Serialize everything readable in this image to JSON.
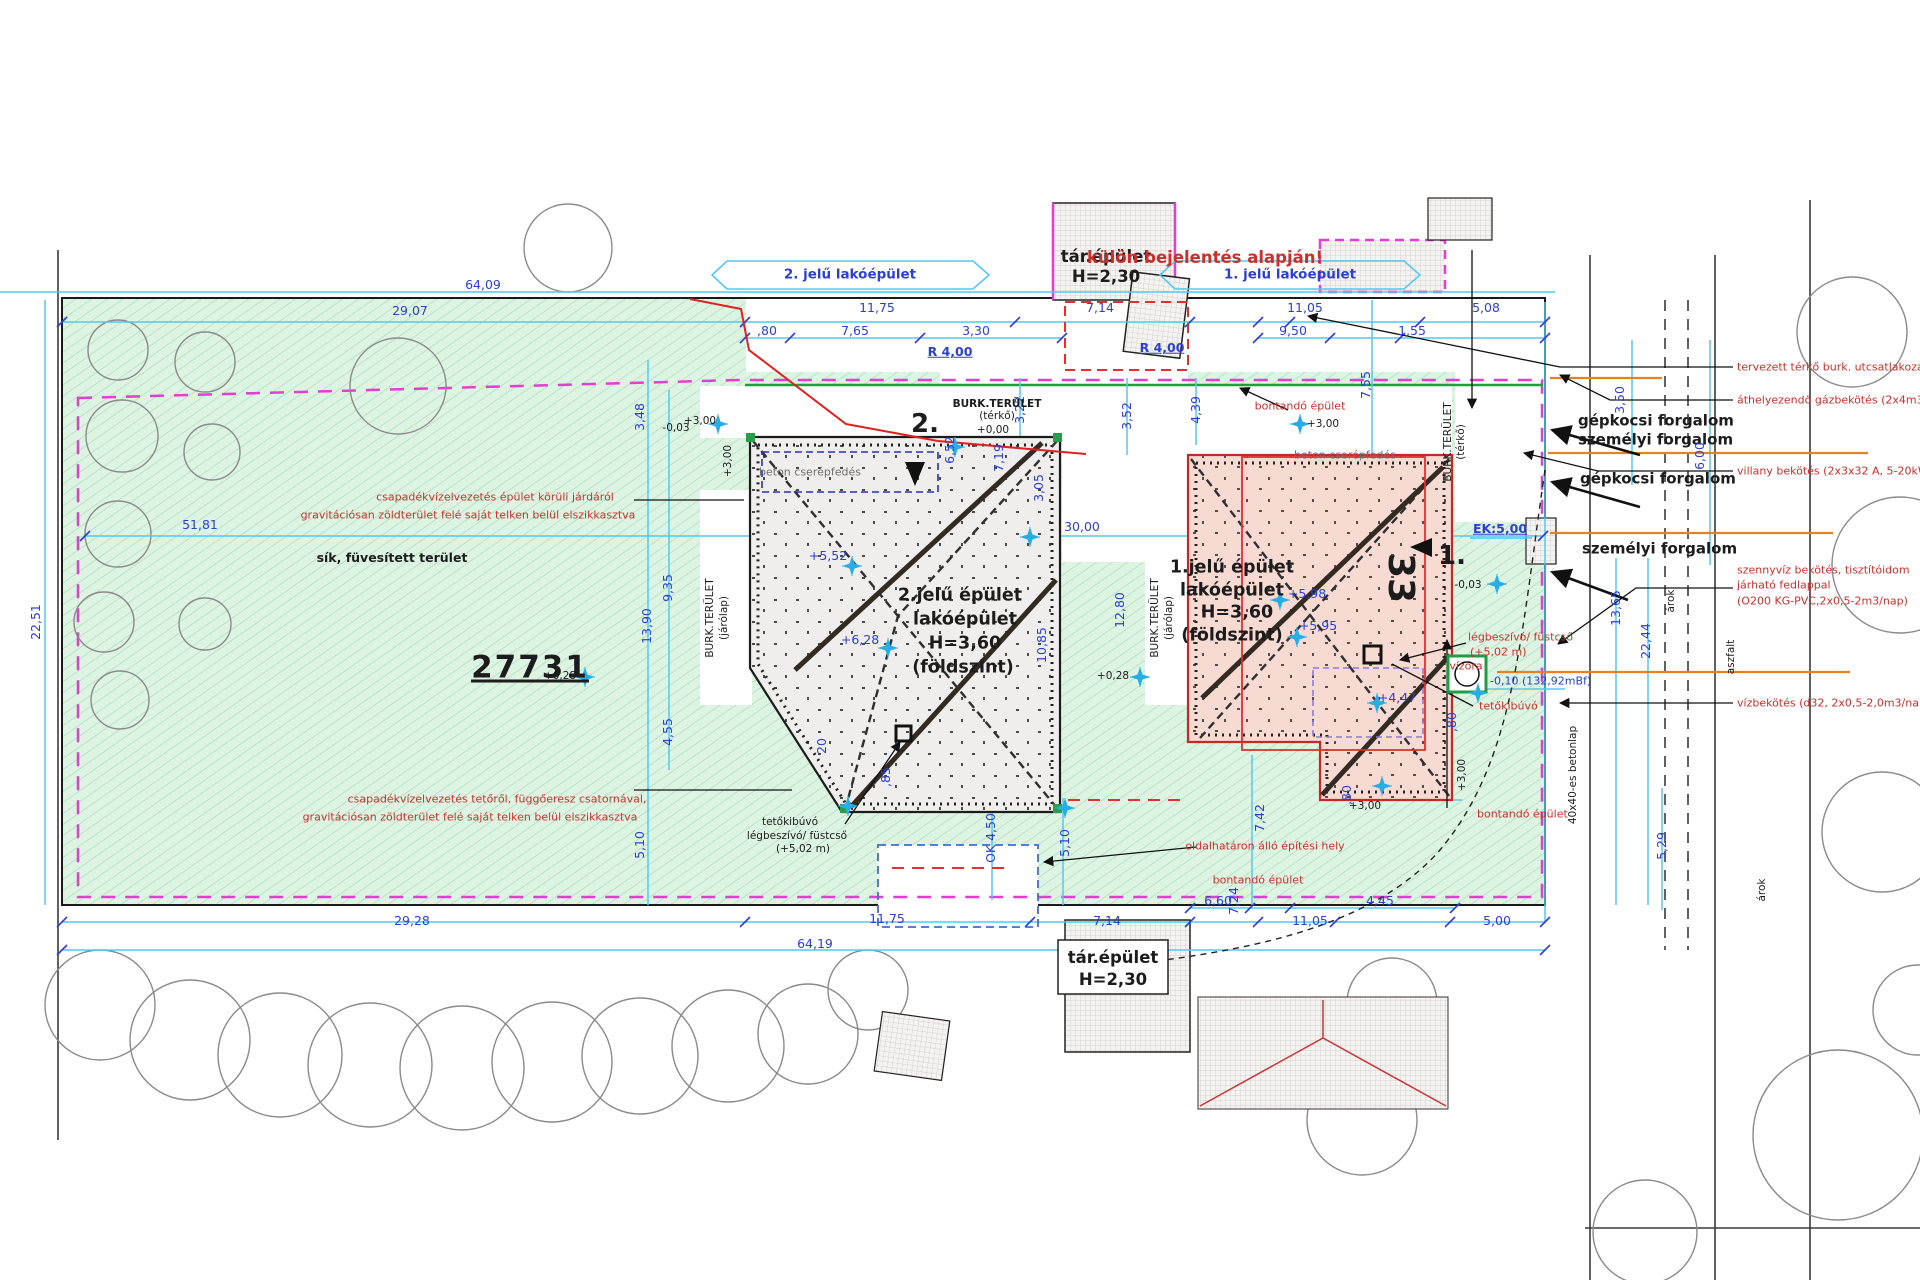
{
  "meta": {
    "title": "Helyszínrajz - telek beépítési terv",
    "parcel_number": "27731",
    "note": "külön bejelentés alapján!"
  },
  "colors": {
    "dimension_blue": "#2b3fd0",
    "dimension_line_cyan": "#56c7ee",
    "annotation_red": "#c9302c",
    "lot_green": "#def4e3",
    "boundary_magenta": "#e23ed0",
    "boundary_green": "#1f9e40",
    "utility_orange": "#e8821e",
    "building1_fill": "#f7dbd3",
    "building2_fill": "#efeeec"
  },
  "buildings": {
    "left": {
      "name": "2.jelű épület",
      "type": "lakóépület",
      "height": "H=3,60",
      "level": "(földszint)",
      "roof": "beton cserépfedés"
    },
    "right": {
      "name": "1.jelű épület",
      "type": "lakóépület",
      "height": "H=3,60",
      "level": "(földszint)",
      "roof": "beton cserépfedés",
      "house_number": "33"
    },
    "aux": {
      "name": "tár.épület",
      "height": "H=2,30"
    }
  },
  "labels": [
    {
      "n": "label-lakoepulet-2",
      "t": "2. jelű lakóépület",
      "x": 850,
      "y": 275,
      "c": "c-dim s13 b"
    },
    {
      "n": "label-tarepulet-top",
      "t": "tár.épület",
      "x": 1106,
      "y": 257,
      "c": "c-blk s16 b"
    },
    {
      "n": "label-tarepulet-top-h",
      "t": "H=2,30",
      "x": 1106,
      "y": 277,
      "c": "c-blk s16 b"
    },
    {
      "n": "label-kulon-bejelentes",
      "t": "külön bejelentés alapján!",
      "x": 1205,
      "y": 258,
      "c": "c-red s16 b"
    },
    {
      "n": "label-lakoepulet-1",
      "t": "1. jelű lakóépület",
      "x": 1290,
      "y": 275,
      "c": "c-dim s13 b"
    },
    {
      "t": "64,09",
      "x": 483,
      "y": 285,
      "c": "c-dim s12"
    },
    {
      "t": "29,07",
      "x": 410,
      "y": 311,
      "c": "c-dim s12"
    },
    {
      "t": "11,75",
      "x": 877,
      "y": 308,
      "c": "c-dim s12"
    },
    {
      "t": "7,14",
      "x": 1100,
      "y": 308,
      "c": "c-dim s12"
    },
    {
      "t": "11,05",
      "x": 1305,
      "y": 308,
      "c": "c-dim s12"
    },
    {
      "t": "5,08",
      "x": 1486,
      "y": 308,
      "c": "c-dim s12"
    },
    {
      "t": ",80",
      "x": 767,
      "y": 331,
      "c": "c-dim s12"
    },
    {
      "t": "7,65",
      "x": 855,
      "y": 331,
      "c": "c-dim s12"
    },
    {
      "t": "3,30",
      "x": 976,
      "y": 331,
      "c": "c-dim s12"
    },
    {
      "t": "9,50",
      "x": 1293,
      "y": 331,
      "c": "c-dim s12"
    },
    {
      "t": "1,55",
      "x": 1412,
      "y": 331,
      "c": "c-dim s12"
    },
    {
      "t": "R 4,00",
      "x": 950,
      "y": 352,
      "c": "c-dim s12 b u"
    },
    {
      "t": "R 4,00",
      "x": 1162,
      "y": 348,
      "c": "c-dim s12 b u"
    },
    {
      "t": "7,55",
      "x": 1366,
      "y": 385,
      "c": "c-dim s12 rot"
    },
    {
      "t": "3,22",
      "x": 1020,
      "y": 410,
      "c": "c-dim s12 rot"
    },
    {
      "t": "3,52",
      "x": 1127,
      "y": 416,
      "c": "c-dim s12 rot"
    },
    {
      "t": "4,39",
      "x": 1196,
      "y": 410,
      "c": "c-dim s12 rot"
    },
    {
      "n": "label-burkterulet-terko",
      "t": "BURK.TERÜLET",
      "x": 997,
      "y": 404,
      "c": "c-blk s10 b"
    },
    {
      "t": "(térkő)",
      "x": 997,
      "y": 416,
      "c": "c-blk s10"
    },
    {
      "t": "+0,00",
      "x": 993,
      "y": 430,
      "c": "c-blk s10"
    },
    {
      "t": "+3,00",
      "x": 700,
      "y": 421,
      "c": "c-blk s10"
    },
    {
      "t": "-0,03",
      "x": 676,
      "y": 428,
      "c": "c-blk s10"
    },
    {
      "t": "3,48",
      "x": 640,
      "y": 417,
      "c": "c-dim s12 rot"
    },
    {
      "t": "+3,00",
      "x": 728,
      "y": 461,
      "c": "c-blk s10 rot"
    },
    {
      "t": "+3,00",
      "x": 1323,
      "y": 424,
      "c": "c-blk s10"
    },
    {
      "t": "6,52",
      "x": 950,
      "y": 450,
      "c": "c-dim s12 rot"
    },
    {
      "t": "7,19",
      "x": 999,
      "y": 458,
      "c": "c-dim s12 rot"
    },
    {
      "t": "3,05",
      "x": 1039,
      "y": 488,
      "c": "c-dim s12 rot"
    },
    {
      "n": "label-bontando-top",
      "t": "bontandó épület",
      "x": 1300,
      "y": 406,
      "c": "c-red s11"
    },
    {
      "n": "label-tervezett-terko",
      "t": "tervezett térkő burk. utcsatlakozás",
      "x": 1737,
      "y": 367,
      "c": "c-red s11 la"
    },
    {
      "n": "label-gazbekotes",
      "t": "áthelyezendő gázbekötés (2x4m3/h)",
      "x": 1737,
      "y": 400,
      "c": "c-red s11 la"
    },
    {
      "n": "label-gepkocsi-1",
      "t": "gépkocsi forgalom",
      "x": 1578,
      "y": 421,
      "c": "c-blk s15 b la"
    },
    {
      "n": "label-szemelyi-1",
      "t": "személyi forgalom",
      "x": 1578,
      "y": 440,
      "c": "c-blk s15 b la"
    },
    {
      "t": "3,50",
      "x": 1620,
      "y": 400,
      "c": "c-dim s12 rot"
    },
    {
      "n": "label-villany",
      "t": "villany bekötés (2x3x32 A, 5-20kWh)",
      "x": 1737,
      "y": 471,
      "c": "c-red s11 la"
    },
    {
      "n": "label-gepkocsi-2",
      "t": "gépkocsi forgalom",
      "x": 1580,
      "y": 479,
      "c": "c-blk s15 b la"
    },
    {
      "t": "6,00",
      "x": 1700,
      "y": 456,
      "c": "c-dim s12 rot"
    },
    {
      "n": "label-szemelyi-2",
      "t": "személyi forgalom",
      "x": 1582,
      "y": 549,
      "c": "c-blk s15 b la"
    },
    {
      "n": "label-szennyviz-1",
      "t": "szennyvíz bekötés, tisztítóidom",
      "x": 1737,
      "y": 570,
      "c": "c-red s11 la"
    },
    {
      "t": "járható fedlappal",
      "x": 1737,
      "y": 585,
      "c": "c-red s11 la"
    },
    {
      "t": "(O200 KG-PVC,2x0,5-2m3/nap)",
      "x": 1737,
      "y": 601,
      "c": "c-red s11 la"
    },
    {
      "n": "label-vizbekotes",
      "t": "vízbekötés (d32, 2x0,5-2,0m3/nap)",
      "x": 1737,
      "y": 703,
      "c": "c-red s11 la"
    },
    {
      "t": "árok",
      "x": 1671,
      "y": 601,
      "c": "c-blk s10 rot"
    },
    {
      "t": "aszfalt",
      "x": 1731,
      "y": 657,
      "c": "c-blk s10 rot"
    },
    {
      "t": "13,65",
      "x": 1616,
      "y": 608,
      "c": "c-dim s12 rot"
    },
    {
      "t": "22,44",
      "x": 1646,
      "y": 641,
      "c": "c-dim s12 rot"
    },
    {
      "t": "5,29",
      "x": 1662,
      "y": 846,
      "c": "c-dim s12 rot"
    },
    {
      "t": "árok",
      "x": 1762,
      "y": 890,
      "c": "c-blk s10 rot"
    },
    {
      "t": "40x40-es betonlap",
      "x": 1573,
      "y": 775,
      "c": "c-blk s10 rot"
    },
    {
      "t": "51,81",
      "x": 200,
      "y": 525,
      "c": "c-dim s12"
    },
    {
      "t": "22,51",
      "x": 36,
      "y": 622,
      "c": "c-dim s12 rot"
    },
    {
      "n": "label-fuvesitett",
      "t": "sík, füvesített terület",
      "x": 392,
      "y": 558,
      "c": "c-blk s12 b"
    },
    {
      "n": "parcel-number",
      "t": "27731",
      "x": 530,
      "y": 668,
      "c": "c-blk s30 b u"
    },
    {
      "n": "label-csapadek-1a",
      "t": "csapadékvízelvezetés épület körüli járdáról",
      "x": 495,
      "y": 497,
      "c": "c-red s11"
    },
    {
      "t": "gravitációsan zöldterület felé saját telken belül elszikkasztva",
      "x": 468,
      "y": 515,
      "c": "c-red s11"
    },
    {
      "n": "label-csapadek-2a",
      "t": "csapadékvízelvezetés tetőről, függőeresz csatornával,",
      "x": 497,
      "y": 799,
      "c": "c-red s11"
    },
    {
      "t": "gravitációsan zöldterület felé saját telken belül elszikkasztva",
      "x": 470,
      "y": 817,
      "c": "c-red s11"
    },
    {
      "n": "marker-2",
      "t": "2.",
      "x": 925,
      "y": 424,
      "c": "c-blk s26 b"
    },
    {
      "n": "marker-1",
      "t": "1.",
      "x": 1452,
      "y": 556,
      "c": "c-blk s26 b"
    },
    {
      "t": "beton cserépfedés",
      "x": 810,
      "y": 472,
      "c": "c-gray s11"
    },
    {
      "t": "beton cserépfedés",
      "x": 1345,
      "y": 455,
      "c": "c-gray s11"
    },
    {
      "n": "building2-title",
      "t": "2.jelű épület",
      "x": 960,
      "y": 596,
      "c": "c-blk s17 b"
    },
    {
      "t": "lakóépület",
      "x": 965,
      "y": 620,
      "c": "c-blk s17 b"
    },
    {
      "t": "H=3,60",
      "x": 965,
      "y": 644,
      "c": "c-blk s17 b"
    },
    {
      "t": "(földszint)",
      "x": 963,
      "y": 668,
      "c": "c-blk s17 b"
    },
    {
      "n": "building1-title",
      "t": "1.jelű épület",
      "x": 1232,
      "y": 568,
      "c": "c-blk s17 b"
    },
    {
      "t": "lakóépület",
      "x": 1232,
      "y": 591,
      "c": "c-blk s17 b"
    },
    {
      "t": "H=3,60",
      "x": 1237,
      "y": 613,
      "c": "c-blk s17 b"
    },
    {
      "t": "(földszint)",
      "x": 1232,
      "y": 636,
      "c": "c-blk s17 b"
    },
    {
      "n": "house-number",
      "t": "33",
      "x": 1400,
      "y": 578,
      "c": "c-blk s36 b rot90"
    },
    {
      "t": "+5,52",
      "x": 828,
      "y": 556,
      "c": "c-dim s12"
    },
    {
      "t": "+6,28",
      "x": 860,
      "y": 640,
      "c": "c-dim s12"
    },
    {
      "t": "+5,98",
      "x": 1307,
      "y": 594,
      "c": "c-dim s12"
    },
    {
      "t": "+5,95",
      "x": 1318,
      "y": 626,
      "c": "c-dim s12"
    },
    {
      "t": "+4,47",
      "x": 1397,
      "y": 698,
      "c": "c-dim s12"
    },
    {
      "t": "+0,28",
      "x": 560,
      "y": 676,
      "c": "c-blk s10"
    },
    {
      "t": "+0,28",
      "x": 1113,
      "y": 676,
      "c": "c-blk s10"
    },
    {
      "t": "BURK.TERÜLET",
      "x": 710,
      "y": 618,
      "c": "c-blk s10 rot"
    },
    {
      "t": "(járólap)",
      "x": 724,
      "y": 618,
      "c": "c-blk s10 rot"
    },
    {
      "t": "BURK.TERÜLET",
      "x": 1155,
      "y": 618,
      "c": "c-blk s10 rot"
    },
    {
      "t": "(járólap)",
      "x": 1169,
      "y": 618,
      "c": "c-blk s10 rot"
    },
    {
      "t": "BURK.TERÜLET",
      "x": 1448,
      "y": 442,
      "c": "c-blk s10 rot"
    },
    {
      "t": "(térkő)",
      "x": 1461,
      "y": 442,
      "c": "c-blk s10 rot"
    },
    {
      "t": "EK:5,00",
      "x": 1500,
      "y": 529,
      "c": "c-dim s12 b u"
    },
    {
      "t": "-0,03",
      "x": 1468,
      "y": 585,
      "c": "c-blk s10"
    },
    {
      "t": "30,00",
      "x": 1082,
      "y": 527,
      "c": "c-dim s12"
    },
    {
      "t": "12,80",
      "x": 1120,
      "y": 610,
      "c": "c-dim s12 rot"
    },
    {
      "t": "10,85",
      "x": 1042,
      "y": 645,
      "c": "c-dim s12 rot"
    },
    {
      "n": "label-legbeszivo-1",
      "t": "légbeszívó/ füstcső",
      "x": 1468,
      "y": 637,
      "c": "c-red s11 la"
    },
    {
      "t": "(+5,02 m)",
      "x": 1470,
      "y": 652,
      "c": "c-red s11 la"
    },
    {
      "n": "label-vizora",
      "t": "vízóra",
      "x": 1466,
      "y": 666,
      "c": "c-red s11"
    },
    {
      "t": "-0,10 (132,92mBf)",
      "x": 1490,
      "y": 681,
      "c": "c-dim s11 la"
    },
    {
      "n": "label-tetokibuvo-1",
      "t": "tetőkibúvó",
      "x": 1479,
      "y": 706,
      "c": "c-red s11 la"
    },
    {
      "t": ",80",
      "x": 1452,
      "y": 722,
      "c": "c-dim s12 rot"
    },
    {
      "t": "+3,00",
      "x": 1462,
      "y": 775,
      "c": "c-blk s10 rot"
    },
    {
      "t": ",80",
      "x": 1347,
      "y": 795,
      "c": "c-dim s12 rot"
    },
    {
      "t": "+3,00",
      "x": 1365,
      "y": 806,
      "c": "c-blk s10"
    },
    {
      "n": "label-bontando-right",
      "t": "bontandó épület",
      "x": 1477,
      "y": 814,
      "c": "c-red s11 la"
    },
    {
      "t": "7,42",
      "x": 1260,
      "y": 818,
      "c": "c-dim s12 rot"
    },
    {
      "t": "7,24",
      "x": 1234,
      "y": 901,
      "c": "c-dim s12 rot"
    },
    {
      "n": "label-oldalhataron",
      "t": "oldalhatáron álló építési hely",
      "x": 1265,
      "y": 846,
      "c": "c-red s11"
    },
    {
      "n": "label-bontando-bottom",
      "t": "bontandó épület",
      "x": 1258,
      "y": 880,
      "c": "c-red s11"
    },
    {
      "n": "label-tetokibuvo-2",
      "t": "tetőkibúvó",
      "x": 790,
      "y": 822,
      "c": "c-blk s10"
    },
    {
      "t": "légbeszívó/ füstcső",
      "x": 797,
      "y": 836,
      "c": "c-blk s10"
    },
    {
      "t": "(+5,02 m)",
      "x": 803,
      "y": 849,
      "c": "c-blk s10"
    },
    {
      "t": "5,10",
      "x": 640,
      "y": 845,
      "c": "c-dim s12 rot"
    },
    {
      "t": "9,35",
      "x": 668,
      "y": 588,
      "c": "c-dim s12 rot"
    },
    {
      "t": "13,90",
      "x": 647,
      "y": 626,
      "c": "c-dim s12 rot"
    },
    {
      "t": "4,55",
      "x": 668,
      "y": 732,
      "c": "c-dim s12 rot"
    },
    {
      "t": "20",
      "x": 822,
      "y": 746,
      "c": "c-dim s12 rot"
    },
    {
      "t": ",85",
      "x": 886,
      "y": 777,
      "c": "c-dim s12 rot"
    },
    {
      "t": "OK 4,50",
      "x": 991,
      "y": 838,
      "c": "c-dim s12 rot"
    },
    {
      "t": "5,10",
      "x": 1065,
      "y": 843,
      "c": "c-dim s12 rot"
    },
    {
      "t": "6,60",
      "x": 1218,
      "y": 901,
      "c": "c-dim s12"
    },
    {
      "t": "4,45",
      "x": 1380,
      "y": 901,
      "c": "c-dim s12"
    },
    {
      "t": "29,28",
      "x": 412,
      "y": 921,
      "c": "c-dim s12"
    },
    {
      "t": "11,75",
      "x": 887,
      "y": 919,
      "c": "c-dim s12"
    },
    {
      "t": "7,14",
      "x": 1107,
      "y": 921,
      "c": "c-dim s12"
    },
    {
      "t": "11,05",
      "x": 1310,
      "y": 921,
      "c": "c-dim s12"
    },
    {
      "t": "5,00",
      "x": 1497,
      "y": 921,
      "c": "c-dim s12"
    },
    {
      "t": "64,19",
      "x": 815,
      "y": 944,
      "c": "c-dim s12"
    },
    {
      "n": "label-tarepulet-bottom",
      "t": "tár.épület",
      "x": 1113,
      "y": 958,
      "c": "c-blk s16 b"
    },
    {
      "t": "H=2,30",
      "x": 1113,
      "y": 980,
      "c": "c-blk s16 b"
    }
  ],
  "level_markers": [
    [
      718,
      424
    ],
    [
      955,
      447
    ],
    [
      852,
      566
    ],
    [
      888,
      648
    ],
    [
      585,
      677
    ],
    [
      1140,
      677
    ],
    [
      1030,
      537
    ],
    [
      1280,
      600
    ],
    [
      1297,
      637
    ],
    [
      1377,
      703
    ],
    [
      1497,
      584
    ],
    [
      1478,
      693
    ],
    [
      848,
      806
    ],
    [
      1065,
      808
    ],
    [
      1382,
      786
    ],
    [
      1300,
      424
    ]
  ]
}
